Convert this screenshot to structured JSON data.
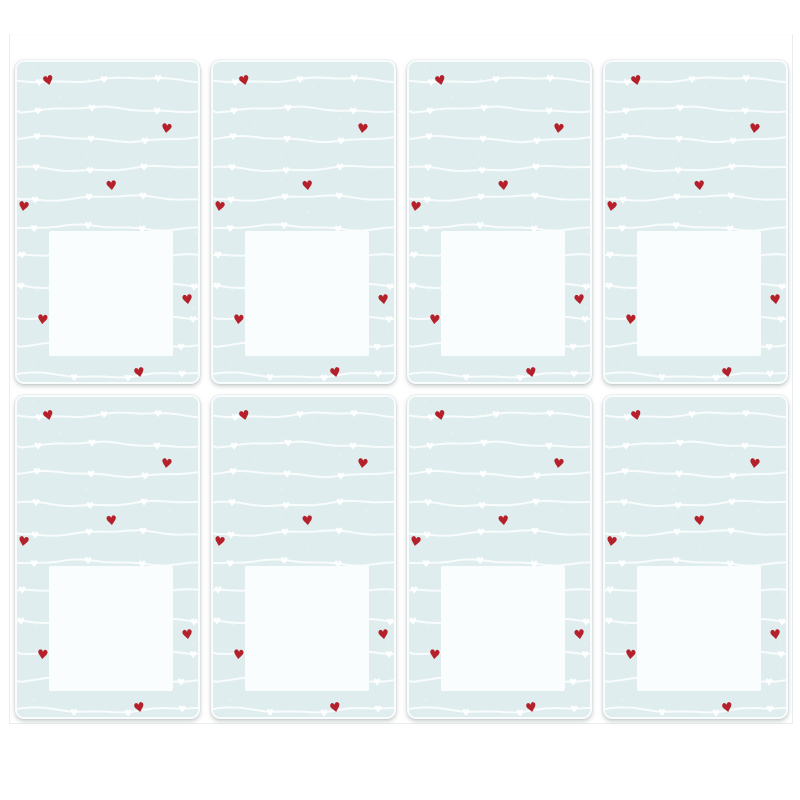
{
  "image": {
    "description": "Photo of eight identical rectangular stickers on a white backing sheet, arranged in two rows of four. Each sticker has a pale blue background with wavy white heart-garland lines, seven small scattered red hearts and a blank white square label area.",
    "page_background": "#ffffff"
  },
  "sheet": {
    "background": "#ffffff",
    "edge_color": "#e9eded",
    "rows": 2,
    "columns": 4,
    "sticker_count": 8
  },
  "sticker": {
    "background_color": "#dfedef",
    "corner_radius": 9,
    "width": 185,
    "height": 324,
    "garland": {
      "line_color": "#ffffff",
      "line_opacity": 0.8,
      "line_count": 11,
      "first_line_y": 20,
      "line_spacing": 29.5,
      "white_heart_color": "#ffffff"
    },
    "label_square": {
      "fill": "#f9fdfd",
      "left": 34,
      "top": 171,
      "width": 124,
      "height": 125
    },
    "red_hearts": {
      "color": "#b5212a",
      "glyph": "♥",
      "count_per_sticker": 7,
      "positions": [
        {
          "x": 33,
          "y": 22,
          "rot": -14
        },
        {
          "x": 151,
          "y": 70,
          "rot": 8
        },
        {
          "x": 96,
          "y": 127,
          "rot": -6
        },
        {
          "x": 8,
          "y": 148,
          "rot": 10
        },
        {
          "x": 172,
          "y": 241,
          "rot": -8
        },
        {
          "x": 27,
          "y": 261,
          "rot": 6
        },
        {
          "x": 124,
          "y": 314,
          "rot": -12
        }
      ]
    }
  }
}
